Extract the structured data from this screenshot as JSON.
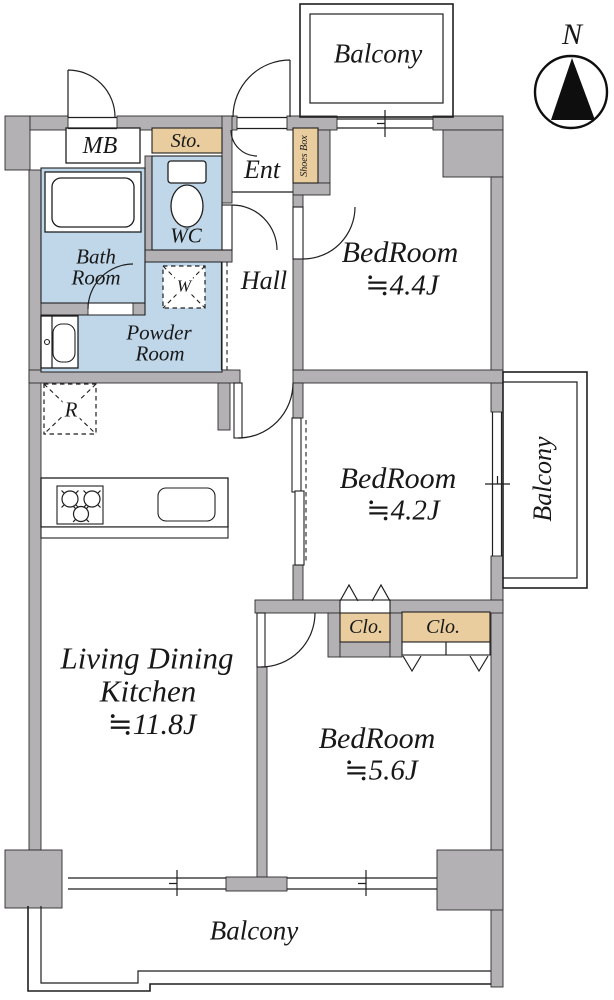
{
  "plan": {
    "compass_north": "N",
    "balcony_top": "Balcony",
    "balcony_right": "Balcony",
    "balcony_bottom": "Balcony",
    "mb": "MB",
    "storage": "Sto.",
    "entrance": "Ent",
    "shoes_box": "Shoes Box",
    "wc": "WC",
    "bath_line1": "Bath",
    "bath_line2": "Room",
    "hall": "Hall",
    "washer_mark": "W",
    "powder_line1": "Powder",
    "powder_line2": "Room",
    "fridge_mark": "R",
    "bedroom_a_name": "BedRoom",
    "bedroom_a_size": "≒4.4J",
    "bedroom_b_name": "BedRoom",
    "bedroom_b_size": "≒4.2J",
    "bedroom_c_name": "BedRoom",
    "bedroom_c_size": "≒5.6J",
    "ldk_line1": "Living Dining",
    "ldk_line2": "Kitchen",
    "ldk_size": "≒11.8J",
    "closet_a": "Clo.",
    "closet_b": "Clo."
  },
  "colors": {
    "wall": "#b4b1b5",
    "wet_area": "#bfd7e9",
    "storage_fill": "#e9cd9f"
  }
}
